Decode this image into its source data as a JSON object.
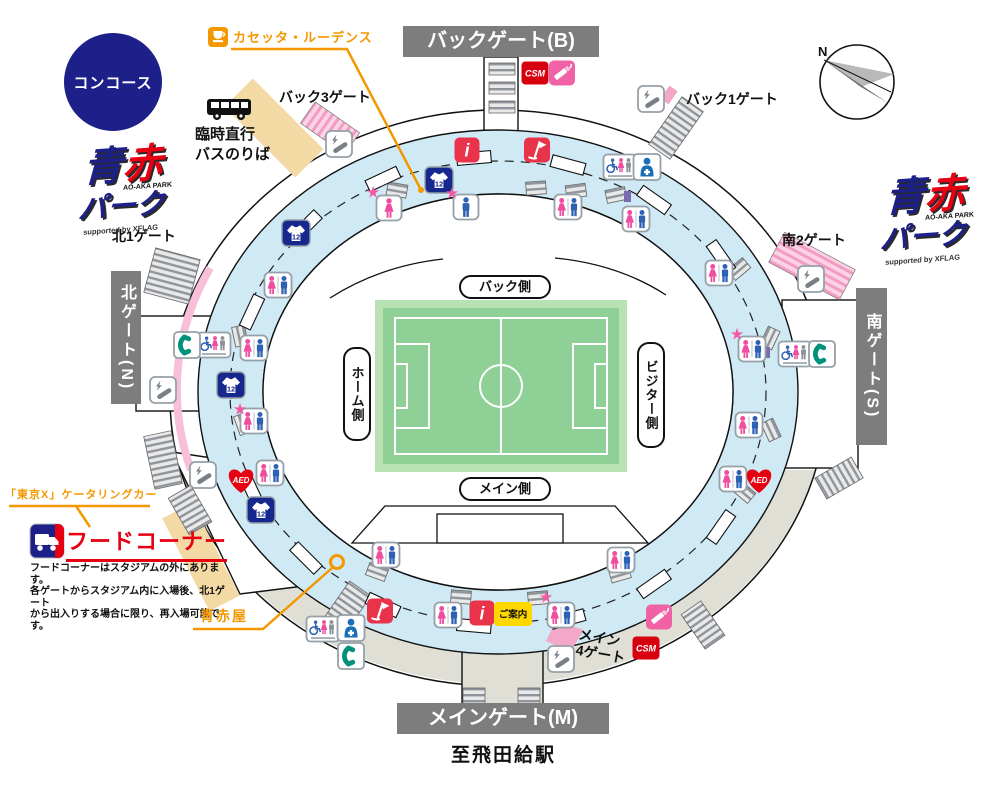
{
  "map": {
    "concourse": "コンコース",
    "compass_n": "N",
    "banners": {
      "back": "バックゲート(B)",
      "main": "メインゲート(M)",
      "north": "北ゲート(N)",
      "south": "南ゲート(S)"
    },
    "gate_labels": {
      "back3": "バック3ゲート",
      "back1": "バック1ゲート",
      "north1": "北1ゲート",
      "south2": "南2ゲート",
      "main4_line1": "メイン",
      "main4_line2": "4ゲート"
    },
    "station": "至飛田給駅",
    "bus_stop": {
      "line1": "臨時直行",
      "line2": "バスのりば"
    },
    "field": {
      "back": "バック側",
      "home": "ホーム側",
      "visitor": "ビジター側",
      "main": "メイン側"
    },
    "vendors": {
      "casetta": "カセッタ・ルーデンス",
      "tokyo_x": "「東京X」ケータリングカー",
      "food_corner": "フードコーナー",
      "aoakaya": "青赤屋",
      "food_note_1": "フードコーナーはスタジアムの外にあります。",
      "food_note_2": "各ゲートからスタジアム内に入場後、北1ゲート",
      "food_note_3": "から出入りする場合に限り、再入場可能です。"
    },
    "logo": {
      "ao": "青",
      "aka": "赤",
      "park": "パーク",
      "sub": "AO-AKA PARK",
      "supported": "supported by XFLAG"
    },
    "badges": {
      "csm": "CSM",
      "info": "i",
      "goods": "12",
      "aed": "AED",
      "guide": "ご案内",
      "star": "★"
    },
    "colors": {
      "navy": "#1d2088",
      "red": "#e60012",
      "pink": "#f062a5",
      "orange": "#f39800",
      "ring_blue": "#cfe9f5",
      "pitch_green": "#8fd096",
      "banner_gray": "#7d7d7d"
    }
  }
}
